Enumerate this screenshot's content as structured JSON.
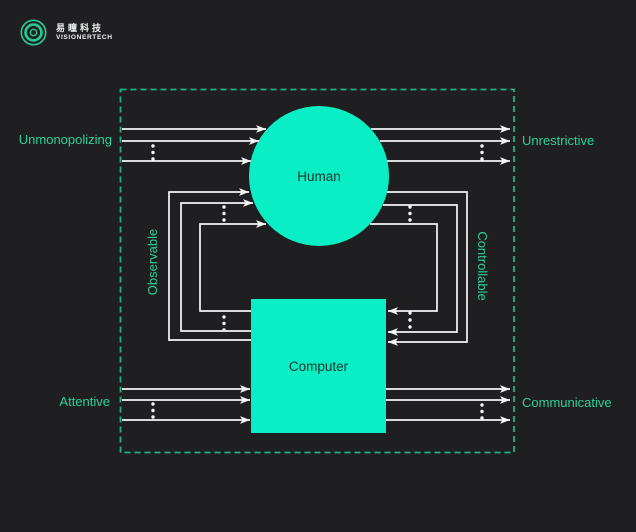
{
  "brand": {
    "icon": "visionertech-eye-icon",
    "name_zh": "易瞳科技",
    "name_en": "VISIONERTECH"
  },
  "diagram": {
    "nodes": {
      "human": "Human",
      "computer": "Computer"
    },
    "edge_labels": {
      "top_left": "Unmonopolizing",
      "top_right": "Unrestrictive",
      "middle_left": "Observable",
      "middle_right": "Controllable",
      "bottom_left": "Attentive",
      "bottom_right": "Communicative"
    },
    "colors": {
      "background": "#1f1f21",
      "node_fill": "#0aeec5",
      "node_text": "#1d352f",
      "label_green": "#2dd096",
      "border_green": "#1db485",
      "arrow_white": "#f5f5f5",
      "brand_green": "#29c795",
      "brand_text": "#eef0ef"
    }
  }
}
